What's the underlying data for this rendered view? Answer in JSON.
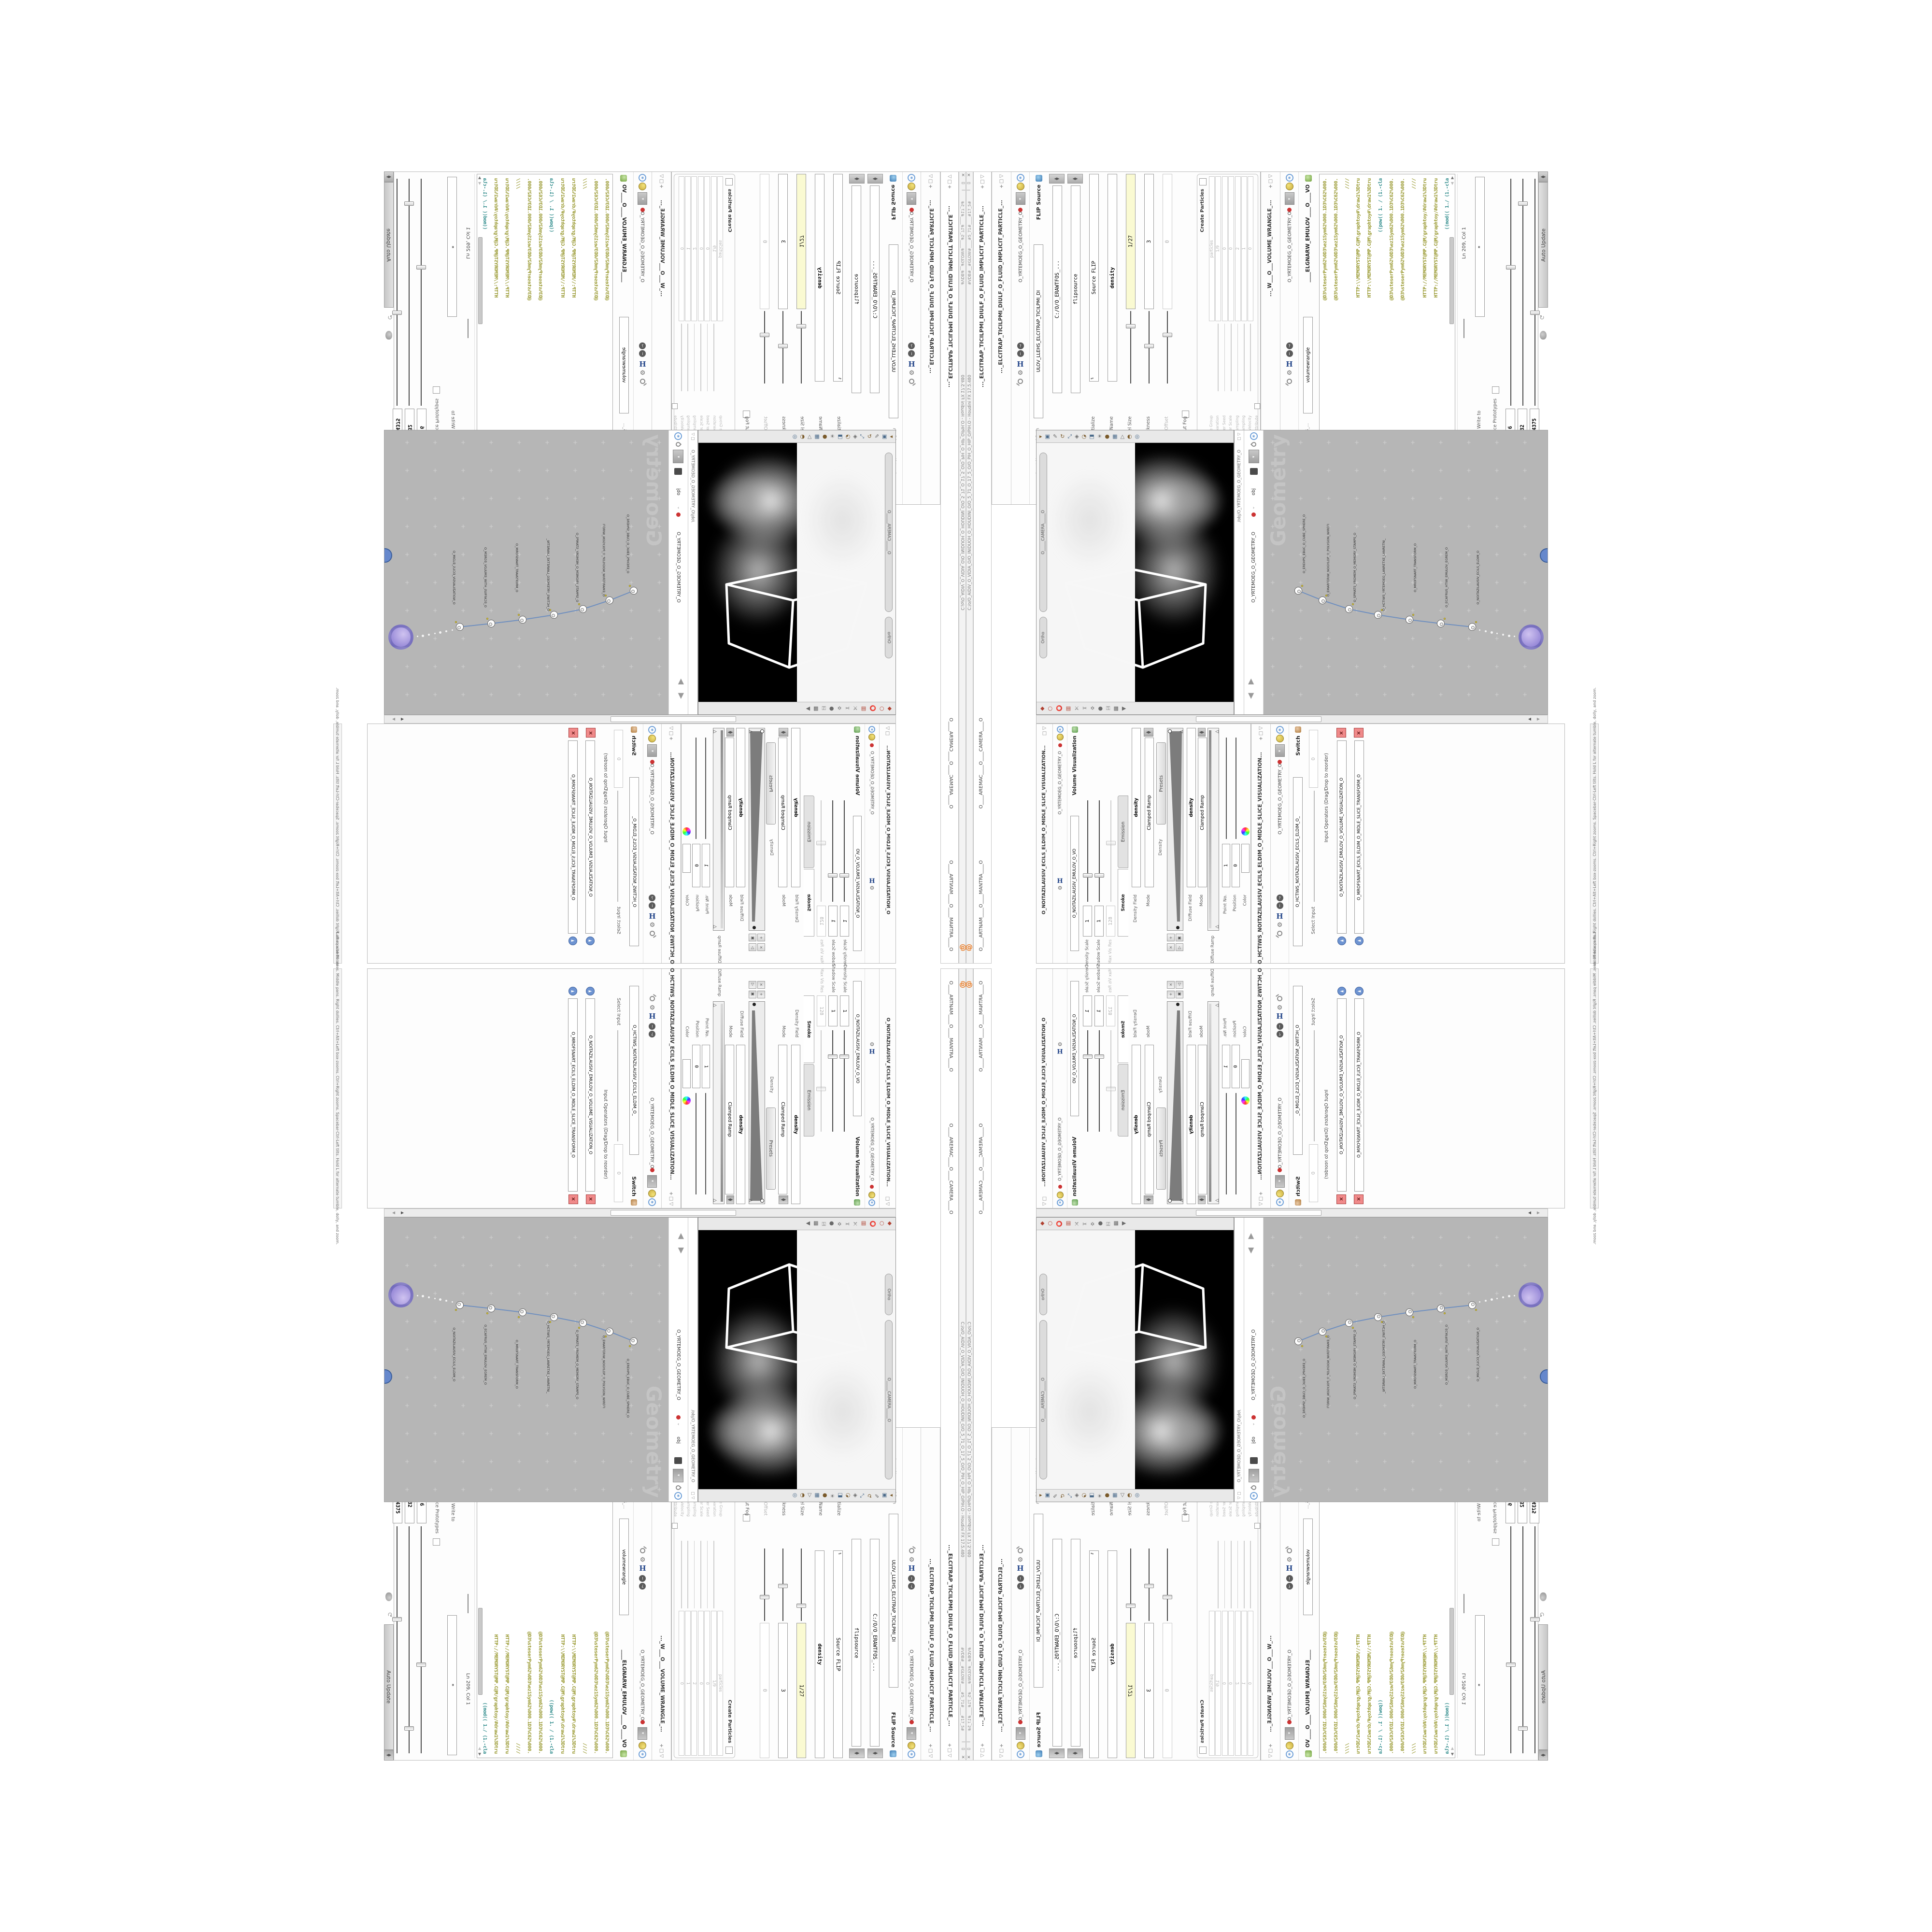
{
  "window": {
    "title": "C:/o/O_AIDIV_O_VIDIA_O/O_INIDUOH_O_HOUDINI_O/O_5_71_O_17_5_O/O_PIH_O_HIP_O/PIH.O - Houdini FX 17.5.480",
    "title_short": "O.HIP - Houdini FX 17.5.480",
    "flags": "#VDB#__#GLOW#____#5_71#____#17_5#",
    "close": "×",
    "restore": "▭",
    "minimize": "—",
    "at_icon": "@"
  },
  "tabs": {
    "tab_flip": "..._ELCITRAP_TICILPMI_DIULF_O_FLUID_IMPLICIT_PARTICLE_...",
    "tab_camera": "O____AREMAC____O____CAMERA____O",
    "tab_mantra": "O____ARTNAM____O____MANTRA____O",
    "modified_star": "*"
  },
  "crumb": {
    "obj": "obj",
    "geometry": "O_YRTEMOEG_O_GEOMETRY_O",
    "sep": "›"
  },
  "flip": {
    "type_label": "FLIP Source",
    "name_value": "ULOV_LLEHS_ELCITRAP_TICILPMI_DI",
    "asset_label": "Asset Name and Path",
    "asset_path": "C:/O/O_ERAWTFOS_...",
    "params": [
      {
        "v": "C:/O/O_ERAWTFOS_...",
        "l": "",
        "cap": true
      },
      {
        "v": "flipsource",
        "l": "",
        "cap": true
      },
      {
        "v": "Source FLIP",
        "l": "Initialize",
        "dd": true
      },
      {
        "v": "density",
        "l": "Volume Name",
        "bold": true
      },
      {
        "v": "1/27",
        "l": "Voxel Size",
        "yellow": true,
        "s": true,
        "pos": 0.18
      },
      {
        "v": "3",
        "l": "Shell Thickness",
        "s": true,
        "pos": 0.45
      },
      {
        "v": "0",
        "l": "Rest Offset",
        "dis": true,
        "s": true,
        "pos": 0.3
      },
      {
        "v": "",
        "l": "Output Fog",
        "chk": true
      }
    ],
    "create_label": "Create Particles",
    "group": [
      {
        "v": "particles",
        "l": "Particle Group",
        "dis": true
      },
      {
        "v": "1/9",
        "l": "Particle Separation",
        "dis": true,
        "s": true,
        "pos": 0.2
      },
      {
        "v": "0",
        "l": "Jitter Seed",
        "dis": true,
        "s": true,
        "pos": 0.5
      },
      {
        "v": "0",
        "l": "Jitter Scale",
        "dis": true,
        "s": true,
        "pos": 0.5
      },
      {
        "v": "2",
        "l": "Oversampling",
        "dis": true,
        "s": true,
        "pos": 0.35
      },
      {
        "v": "1",
        "l": "Oversampling",
        "dis": true,
        "s": true,
        "pos": 0.6
      },
      {
        "v": "0",
        "l": "Velocity",
        "dis": true,
        "s": true,
        "pos": 0.5
      },
      {
        "v": "",
        "l": "Add Rest Attribute",
        "chk": true
      },
      {
        "v": "",
        "l": "Dual Rest Attributes",
        "chk": true,
        "cursor": true
      },
      {
        "v": "0",
        "l": "Rest Offset",
        "dis": true
      }
    ]
  },
  "wrangle": {
    "tab_title": "..._W___O___VOLUME_WRANGLE_...",
    "type_name": "____ELGNARW_EMULOV____O____VO",
    "name_value": "volumewrangle",
    "asset_path": "C:/O/O_ERAWTFOS_...",
    "code": [
      {
        "t": "@D3%steserPym62%0D3%ez1Sym62%000.1D3%C62%000.",
        "c": "olive"
      },
      {
        "t": "@D3%steserPym62%0D3%ez1Sym62%000.1D3%C62%000.",
        "c": "olive"
      },
      {
        "t": "////",
        "c": "olive"
      },
      {
        "t": "HTTP:\\\\MEMORYST@MP.C@M\\graphtoy#\\draw1%3Dtru",
        "c": "olive"
      },
      {
        "t": "HTTP:\\\\MEMORYST@MP.C@M\\graphtoy#\\draw1%3Dtru",
        "c": "olive"
      },
      {
        "t": "((pow((   1. / (1.-cla",
        "c": "teal"
      },
      {
        "t": "@D3%steserPym62%0D3%ez1Sym62%000.1D3%C62%000.",
        "c": "olive"
      },
      {
        "t": "@D3%steserPym62%0D3%ez1Sym62%000.1D3%C62%000.",
        "c": "olive"
      },
      {
        "t": "////",
        "c": "olive"
      },
      {
        "t": "HTTP://MEMORYST@MP.C@M/graphtoy/#draw1%3Dtru",
        "c": "olive"
      },
      {
        "t": "HTTP://MEMORYST@MP.C@M/graphtoy/#draw1%3Dtru",
        "c": "olive"
      },
      {
        "t": "((mod((  1./ (1.-cla",
        "c": "teal"
      }
    ],
    "status": "Ln 209, Col 1",
    "writeto_label": "Volumes to Write to",
    "writeto_value": "*",
    "enforce_label": "Enforce Prototypes",
    "sliders": [
      {
        "label": "O_REMAP_O_POWER...",
        "value": "6",
        "pos": 0.38
      },
      {
        "label": "O_SCALE_O",
        "value": "32",
        "pos": 0.1
      },
      {
        "label": "O_SHIFT_O",
        "value": "1.4375",
        "pos": 0.58
      }
    ],
    "auto_update": "Auto Update"
  },
  "viewport": {
    "camera_pill": "O_____CAMERA_____O",
    "ortho_pill": "Ortho",
    "help": "Left mouse tumbles. Middle pans. Right dollies. Ctrl+Alt+Left box-zooms. Ctrl+Right zooms. Spacebar-Ctrl-Left tilts. Hold L for alternate tumble, dolly, and zoom.",
    "toolbar_icons": [
      "select",
      "handles",
      "move",
      "rotate",
      "scale",
      "snap",
      "viewcube",
      "render",
      "lights",
      "material",
      "grid",
      "wireframe",
      "shade",
      "camera"
    ],
    "bottom_icons": [
      "magnet-point",
      "magnet-edge",
      "magnet-grid",
      "magnet-multi",
      "axis",
      "scissors",
      "jack",
      "sphere-tool",
      "key",
      "dopsheet",
      "flipbook"
    ]
  },
  "network": {
    "pane_path": "/obj/O_YRTEMOEG_O_GEOMETRY_O",
    "watermark": "Geometry",
    "nodes": [
      {
        "label": "an_CubeSphere",
        "name": "O_EREHPS_EBUC_O_CUBE_SPHERE_O"
      },
      {
        "label": "PolyWire",
        "name": "O_EMARFERIW_NOGYLOP_O_POLYGON_WIREFRAME_O"
      },
      {
        "label": "File",
        "name": "O_SPMATS_YROMEM_O_MEMORY_STAMPS_O"
      },
      {
        "label": "Switch",
        "name": "O_HCTIWS_YRTEMOEG_LANRETXE_LANRETNI_O"
      },
      {
        "label": "Transform",
        "name": "O_MROFSNART_TRANSFORM_O"
      },
      {
        "label": "Merge",
        "name": "O_ECAFRUS_HTIW_EMULOV_EGREM_O"
      },
      {
        "label": "Slice",
        "name": "O_NOITAZILAUSIV_ECILS_ELDIM_O"
      }
    ],
    "result_node": "O_TRANSPART_TLUZER_O_RESULT_TRANSPARENT_O"
  },
  "volviz": {
    "tab_title": "O_NOITAZILAUSIV_ECILS_ELDIM_O_MIDLE_SLICE_VISUALIZATION...",
    "title": "Volume Visualization",
    "name_value": "O_NOITAZILAUSIV_EMULOV_O_VO",
    "sliders": [
      {
        "label": "Density Scale",
        "value": "1",
        "pos": 0.72
      },
      {
        "label": "Shadow Scale",
        "value": "1",
        "pos": 0.72
      },
      {
        "label": "Max Vis Res",
        "value": "128",
        "pos": 0.4,
        "dis": true
      }
    ],
    "folder_tabs": [
      "Emission",
      "Smoke"
    ],
    "density_field_label": "Density Field",
    "density_field": "density",
    "mode_label": "Mode",
    "mode_value": "Clamped Ramp",
    "presets_label": "Presets",
    "density_group_label": "Density",
    "density_ramp_label": "Density Ramp",
    "diffuse_field_label": "Diffuse Field",
    "diffuse_field": "density",
    "mode2_value": "Clamped Ramp",
    "diffuse_ramp_label": "Diffuse Ramp",
    "point_no_label": "Point No.",
    "point_no": "1",
    "position_label": "Position",
    "position": "0",
    "color_label": "Color",
    "interp_label": "Interpolation",
    "interp": "Linear",
    "values": [
      "1.8125",
      "1.8125",
      "1.8125"
    ]
  },
  "switch": {
    "tab_title": "O_HCTIWS_NOITAZILAUSIV_ECILS_ELDIM_O_MIDLE_SLICE_VISUALIZATION...",
    "type_label": "Switch",
    "name_value": "O_HCTIWS_NOITAZILAUSIV_ECILS_ELDIM_O_",
    "select_label": "Select Input",
    "select_value": "0",
    "list_label": "Input Operators (Drag/Drop to reorder)",
    "inputs": [
      "O_NOITAZILAUSIV_EMULOV_O_VOLUME_VISUALIZATION_O",
      "O_MROFSNART_ECILS_ELDIM_O_MIDLE_SLICE_TRANSFORM_O"
    ]
  },
  "colors": {
    "olive": "#9a9a33",
    "teal": "#2e8b8b",
    "net_canvas": "#b6b6b6",
    "node_purple": "#8677d0",
    "accent_orange": "#e87820",
    "yellow_field": "#fafad2",
    "red_button": "#f08a8a",
    "blue_wire": "#6f8fbf"
  }
}
